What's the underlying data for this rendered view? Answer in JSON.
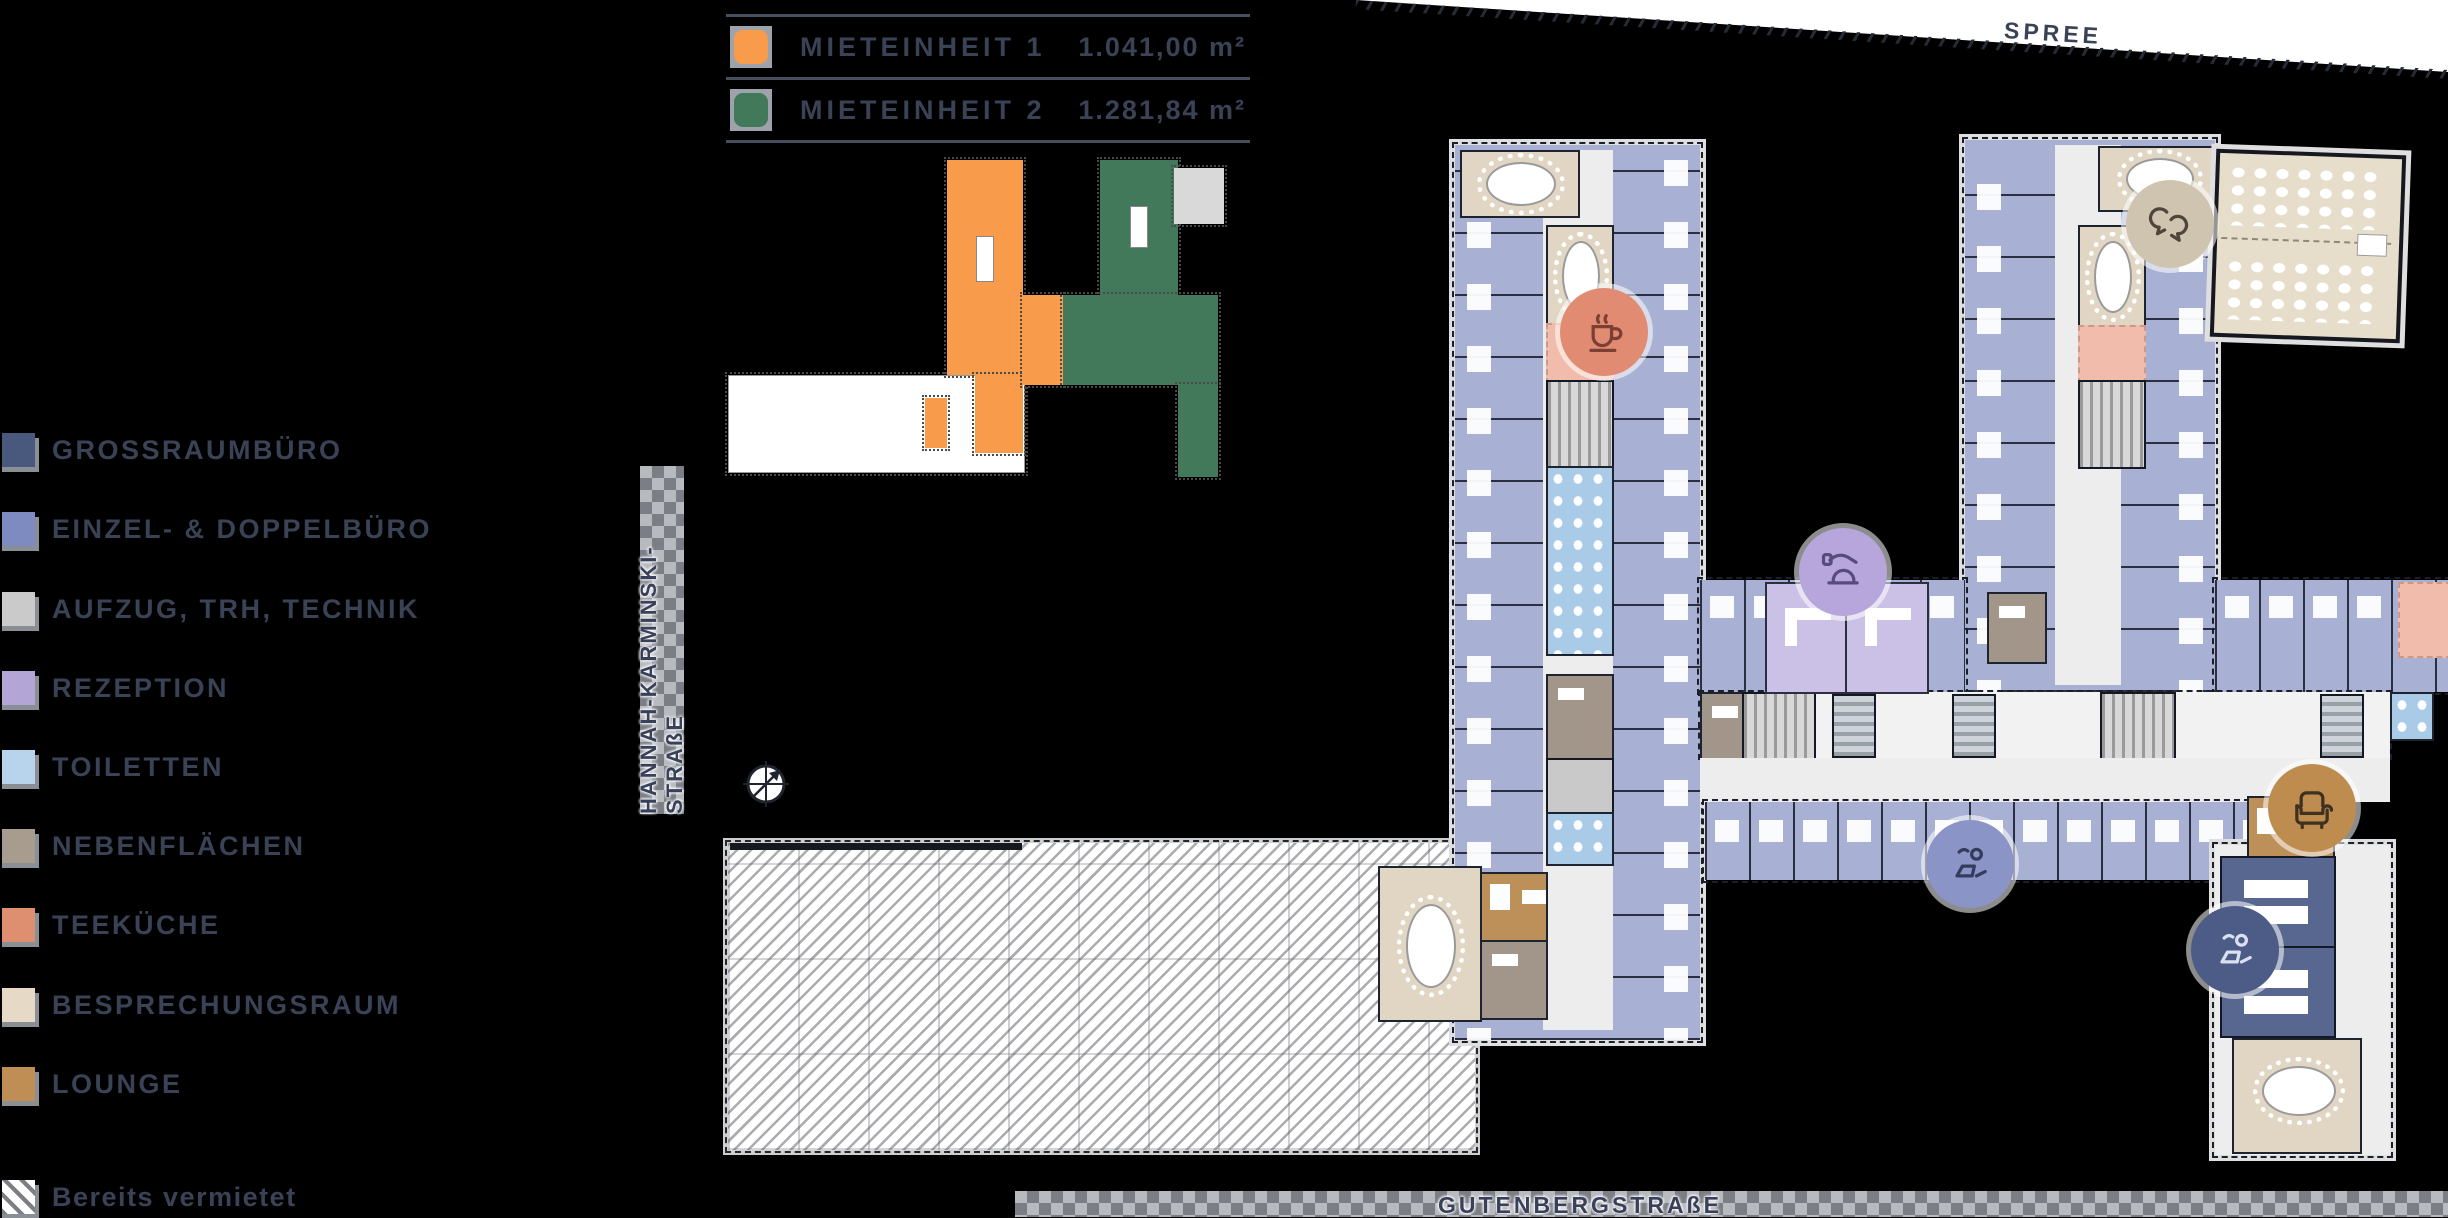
{
  "key_legend": {
    "rows": [
      {
        "label": "MIETEINHEIT 1",
        "area": "1.041,00 m²",
        "color": "#F89B4B"
      },
      {
        "label": "MIETEINHEIT 2",
        "area": "1.281,84 m²",
        "color": "#42795A"
      }
    ]
  },
  "legend": {
    "items": [
      {
        "label": "GROSSRAUMBÜRO",
        "color": "#48597D"
      },
      {
        "label": "EINZEL- & DOPPELBÜRO",
        "color": "#7E8BC0"
      },
      {
        "label": "AUFZUG, TRH, TECHNIK",
        "color": "#CACACA"
      },
      {
        "label": "REZEPTION",
        "color": "#B4A5D7"
      },
      {
        "label": "TOILETTEN",
        "color": "#B7D4EC"
      },
      {
        "label": "NEBENFLÄCHEN",
        "color": "#A79C8E"
      },
      {
        "label": "TEEKÜCHE",
        "color": "#DE8F70"
      },
      {
        "label": "BESPRECHUNGSRAUM",
        "color": "#E6D9C5"
      },
      {
        "label": "LOUNGE",
        "color": "#BE8E55"
      },
      {
        "label": "Bereits vermietet",
        "color": "hatch"
      }
    ]
  },
  "streets": {
    "left_vertical": "HANNAH-KARMINSKI-STRAßE",
    "bottom": "GUTENBERGSTRAßE",
    "river": "SPREE"
  },
  "icons": {
    "badges": [
      "coffee-cup",
      "reception-bell",
      "chat-bubbles",
      "workstation-person",
      "armchair",
      "workstation-person"
    ],
    "compass": "north-arrow"
  },
  "plan_colors": {
    "office_single_double": "#A8B1D3",
    "grossraum": "#57678F",
    "corridor": "#EDEDED",
    "rezeption_room": "#CBC0E5",
    "toiletten": "#A9CBE8",
    "nebenflaechen": "#A2968A",
    "teekueche": "#F2BCAC",
    "besprechung": "#E0D6C3",
    "lounge": "#BE9059",
    "technik": "#C9C9C9",
    "mieteinheit1": "#F89B4B",
    "mieteinheit2": "#42795A",
    "text": "#3A4256"
  }
}
